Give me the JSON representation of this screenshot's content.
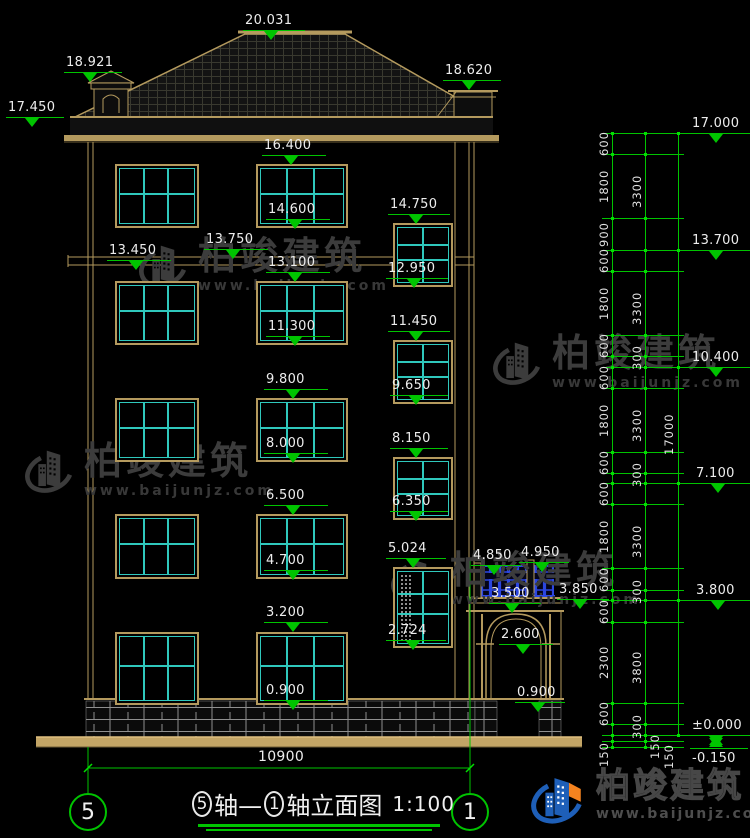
{
  "title": {
    "axis_start": "5",
    "mid": "轴—",
    "axis_end": "1",
    "tail": "轴立面图",
    "scale": "1:100"
  },
  "axes": {
    "left_bubble": "5",
    "right_bubble": "1",
    "span_label": "10900"
  },
  "watermark": {
    "name": "柏竣建筑",
    "url": "www.baijunjz.com"
  },
  "logo": {
    "name": "柏竣建筑",
    "url": "www.baijunjz.com"
  },
  "colors": {
    "dim_green": "#00c400",
    "text_white": "#ededed",
    "wall_tan": "#b49a5e",
    "window_cyan": "#2fc8bc",
    "balustrade_blue": "#2b46e0",
    "logo_blue": "#1e5fb8",
    "logo_orange": "#f5831f",
    "watermark_gray": "#3c3c3c",
    "ground_tan": "#c3a566",
    "background": "#000000"
  },
  "elevation_markers": [
    {
      "t": "20.031",
      "x": 243,
      "y": 30,
      "w": 62
    },
    {
      "t": "18.921",
      "x": 64,
      "y": 72,
      "w": 58
    },
    {
      "t": "17.450",
      "x": 6,
      "y": 117,
      "w": 58
    },
    {
      "t": "18.620",
      "x": 443,
      "y": 80,
      "w": 58
    },
    {
      "t": "16.400",
      "x": 262,
      "y": 155,
      "w": 64
    },
    {
      "t": "14.600",
      "x": 266,
      "y": 219,
      "w": 64
    },
    {
      "t": "13.750",
      "x": 204,
      "y": 249,
      "w": 64
    },
    {
      "t": "13.450",
      "x": 107,
      "y": 260,
      "w": 64
    },
    {
      "t": "13.100",
      "x": 266,
      "y": 272,
      "w": 64
    },
    {
      "t": "11.300",
      "x": 266,
      "y": 336,
      "w": 64
    },
    {
      "t": "14.750",
      "x": 388,
      "y": 214,
      "w": 62
    },
    {
      "t": "12.950",
      "x": 386,
      "y": 278,
      "w": 62
    },
    {
      "t": "11.450",
      "x": 388,
      "y": 331,
      "w": 62
    },
    {
      "t": "9.650",
      "x": 390,
      "y": 395,
      "w": 58
    },
    {
      "t": "9.800",
      "x": 264,
      "y": 389,
      "w": 64
    },
    {
      "t": "8.000",
      "x": 264,
      "y": 453,
      "w": 64
    },
    {
      "t": "8.150",
      "x": 390,
      "y": 448,
      "w": 58
    },
    {
      "t": "6.350",
      "x": 390,
      "y": 511,
      "w": 58
    },
    {
      "t": "6.500",
      "x": 264,
      "y": 505,
      "w": 64
    },
    {
      "t": "4.700",
      "x": 264,
      "y": 570,
      "w": 64
    },
    {
      "t": "5.024",
      "x": 386,
      "y": 558,
      "w": 60
    },
    {
      "t": "2.724",
      "x": 386,
      "y": 640,
      "w": 60
    },
    {
      "t": "3.200",
      "x": 264,
      "y": 622,
      "w": 64
    },
    {
      "t": "0.900",
      "x": 264,
      "y": 700,
      "w": 64
    },
    {
      "t": "4.850",
      "x": 471,
      "y": 565,
      "w": 50
    },
    {
      "t": "4.950",
      "x": 519,
      "y": 562,
      "w": 50
    },
    {
      "t": "3.850",
      "x": 557,
      "y": 599,
      "w": 52
    },
    {
      "t": "3.500",
      "x": 489,
      "y": 603,
      "w": 52
    },
    {
      "t": "2.600",
      "x": 499,
      "y": 644,
      "w": 54
    },
    {
      "t": "0.900",
      "x": 515,
      "y": 702,
      "w": 50
    }
  ],
  "right_markers": [
    {
      "t": "17.000",
      "x": 690,
      "y": 133,
      "w": 58
    },
    {
      "t": "13.700",
      "x": 690,
      "y": 250,
      "w": 58
    },
    {
      "t": "10.400",
      "x": 690,
      "y": 367,
      "w": 58
    },
    {
      "t": "7.100",
      "x": 694,
      "y": 483,
      "w": 54
    },
    {
      "t": "3.800",
      "x": 694,
      "y": 600,
      "w": 54
    },
    {
      "t": "±0.000",
      "x": 690,
      "y": 735,
      "w": 58,
      "sym": "x-below"
    },
    {
      "t": "-0.150",
      "x": 690,
      "y": 748,
      "w": 58,
      "sym": "x-above",
      "labelpos": "below"
    }
  ],
  "dim_labels": [
    {
      "t": "600",
      "x": 597,
      "y": 143
    },
    {
      "t": "1800",
      "x": 597,
      "y": 186
    },
    {
      "t": "900",
      "x": 597,
      "y": 234
    },
    {
      "t": "600",
      "x": 597,
      "y": 260
    },
    {
      "t": "1800",
      "x": 597,
      "y": 303
    },
    {
      "t": "600",
      "x": 597,
      "y": 345
    },
    {
      "t": "300",
      "x": 630,
      "y": 357
    },
    {
      "t": "600",
      "x": 597,
      "y": 377
    },
    {
      "t": "1800",
      "x": 597,
      "y": 420
    },
    {
      "t": "600",
      "x": 597,
      "y": 462
    },
    {
      "t": "300",
      "x": 630,
      "y": 474
    },
    {
      "t": "600",
      "x": 597,
      "y": 493
    },
    {
      "t": "1800",
      "x": 597,
      "y": 536
    },
    {
      "t": "600",
      "x": 597,
      "y": 579
    },
    {
      "t": "300",
      "x": 630,
      "y": 591
    },
    {
      "t": "600",
      "x": 597,
      "y": 611
    },
    {
      "t": "2300",
      "x": 597,
      "y": 662
    },
    {
      "t": "600",
      "x": 597,
      "y": 713
    },
    {
      "t": "300",
      "x": 630,
      "y": 726
    },
    {
      "t": "150",
      "x": 597,
      "y": 754
    },
    {
      "t": "150",
      "x": 648,
      "y": 746
    },
    {
      "t": "150",
      "x": 662,
      "y": 756
    },
    {
      "t": "3300",
      "x": 630,
      "y": 191
    },
    {
      "t": "3300",
      "x": 630,
      "y": 308
    },
    {
      "t": "3300",
      "x": 630,
      "y": 425
    },
    {
      "t": "3300",
      "x": 630,
      "y": 541
    },
    {
      "t": "3800",
      "x": 630,
      "y": 667
    },
    {
      "t": "17000",
      "x": 662,
      "y": 434
    }
  ],
  "dim_chain": {
    "verticals": [
      {
        "x": 612,
        "y1": 133,
        "y2": 747
      },
      {
        "x": 645,
        "y1": 133,
        "y2": 747
      },
      {
        "x": 678,
        "y1": 133,
        "y2": 735
      }
    ],
    "levels": [
      {
        "y": 133,
        "major": true
      },
      {
        "y": 154
      },
      {
        "y": 218
      },
      {
        "y": 250,
        "major": true
      },
      {
        "y": 271
      },
      {
        "y": 335
      },
      {
        "y": 356
      },
      {
        "y": 367,
        "major": true
      },
      {
        "y": 388
      },
      {
        "y": 452
      },
      {
        "y": 473
      },
      {
        "y": 483,
        "major": true
      },
      {
        "y": 504
      },
      {
        "y": 568
      },
      {
        "y": 590
      },
      {
        "y": 600,
        "major": true
      },
      {
        "y": 622
      },
      {
        "y": 703
      },
      {
        "y": 724
      },
      {
        "y": 735,
        "major": true
      },
      {
        "y": 741
      },
      {
        "y": 747
      }
    ]
  },
  "windows": {
    "large_cols": [
      {
        "x": 115,
        "w": 84
      },
      {
        "x": 256,
        "w": 92
      }
    ],
    "large_rows": [
      {
        "y": 164,
        "h": 64
      },
      {
        "y": 281,
        "h": 64
      },
      {
        "y": 398,
        "h": 64
      },
      {
        "y": 514,
        "h": 65
      },
      {
        "y": 632,
        "h": 73
      }
    ],
    "small": {
      "x": 393,
      "w": 60,
      "rows": [
        {
          "y": 223,
          "h": 64
        },
        {
          "y": 340,
          "h": 64
        },
        {
          "y": 457,
          "h": 63
        },
        {
          "y": 567,
          "h": 81,
          "dotted": true
        }
      ]
    }
  },
  "watermarks_positions": [
    {
      "x": 138,
      "y": 236
    },
    {
      "x": 492,
      "y": 333
    },
    {
      "x": 24,
      "y": 441
    },
    {
      "x": 390,
      "y": 550
    }
  ]
}
